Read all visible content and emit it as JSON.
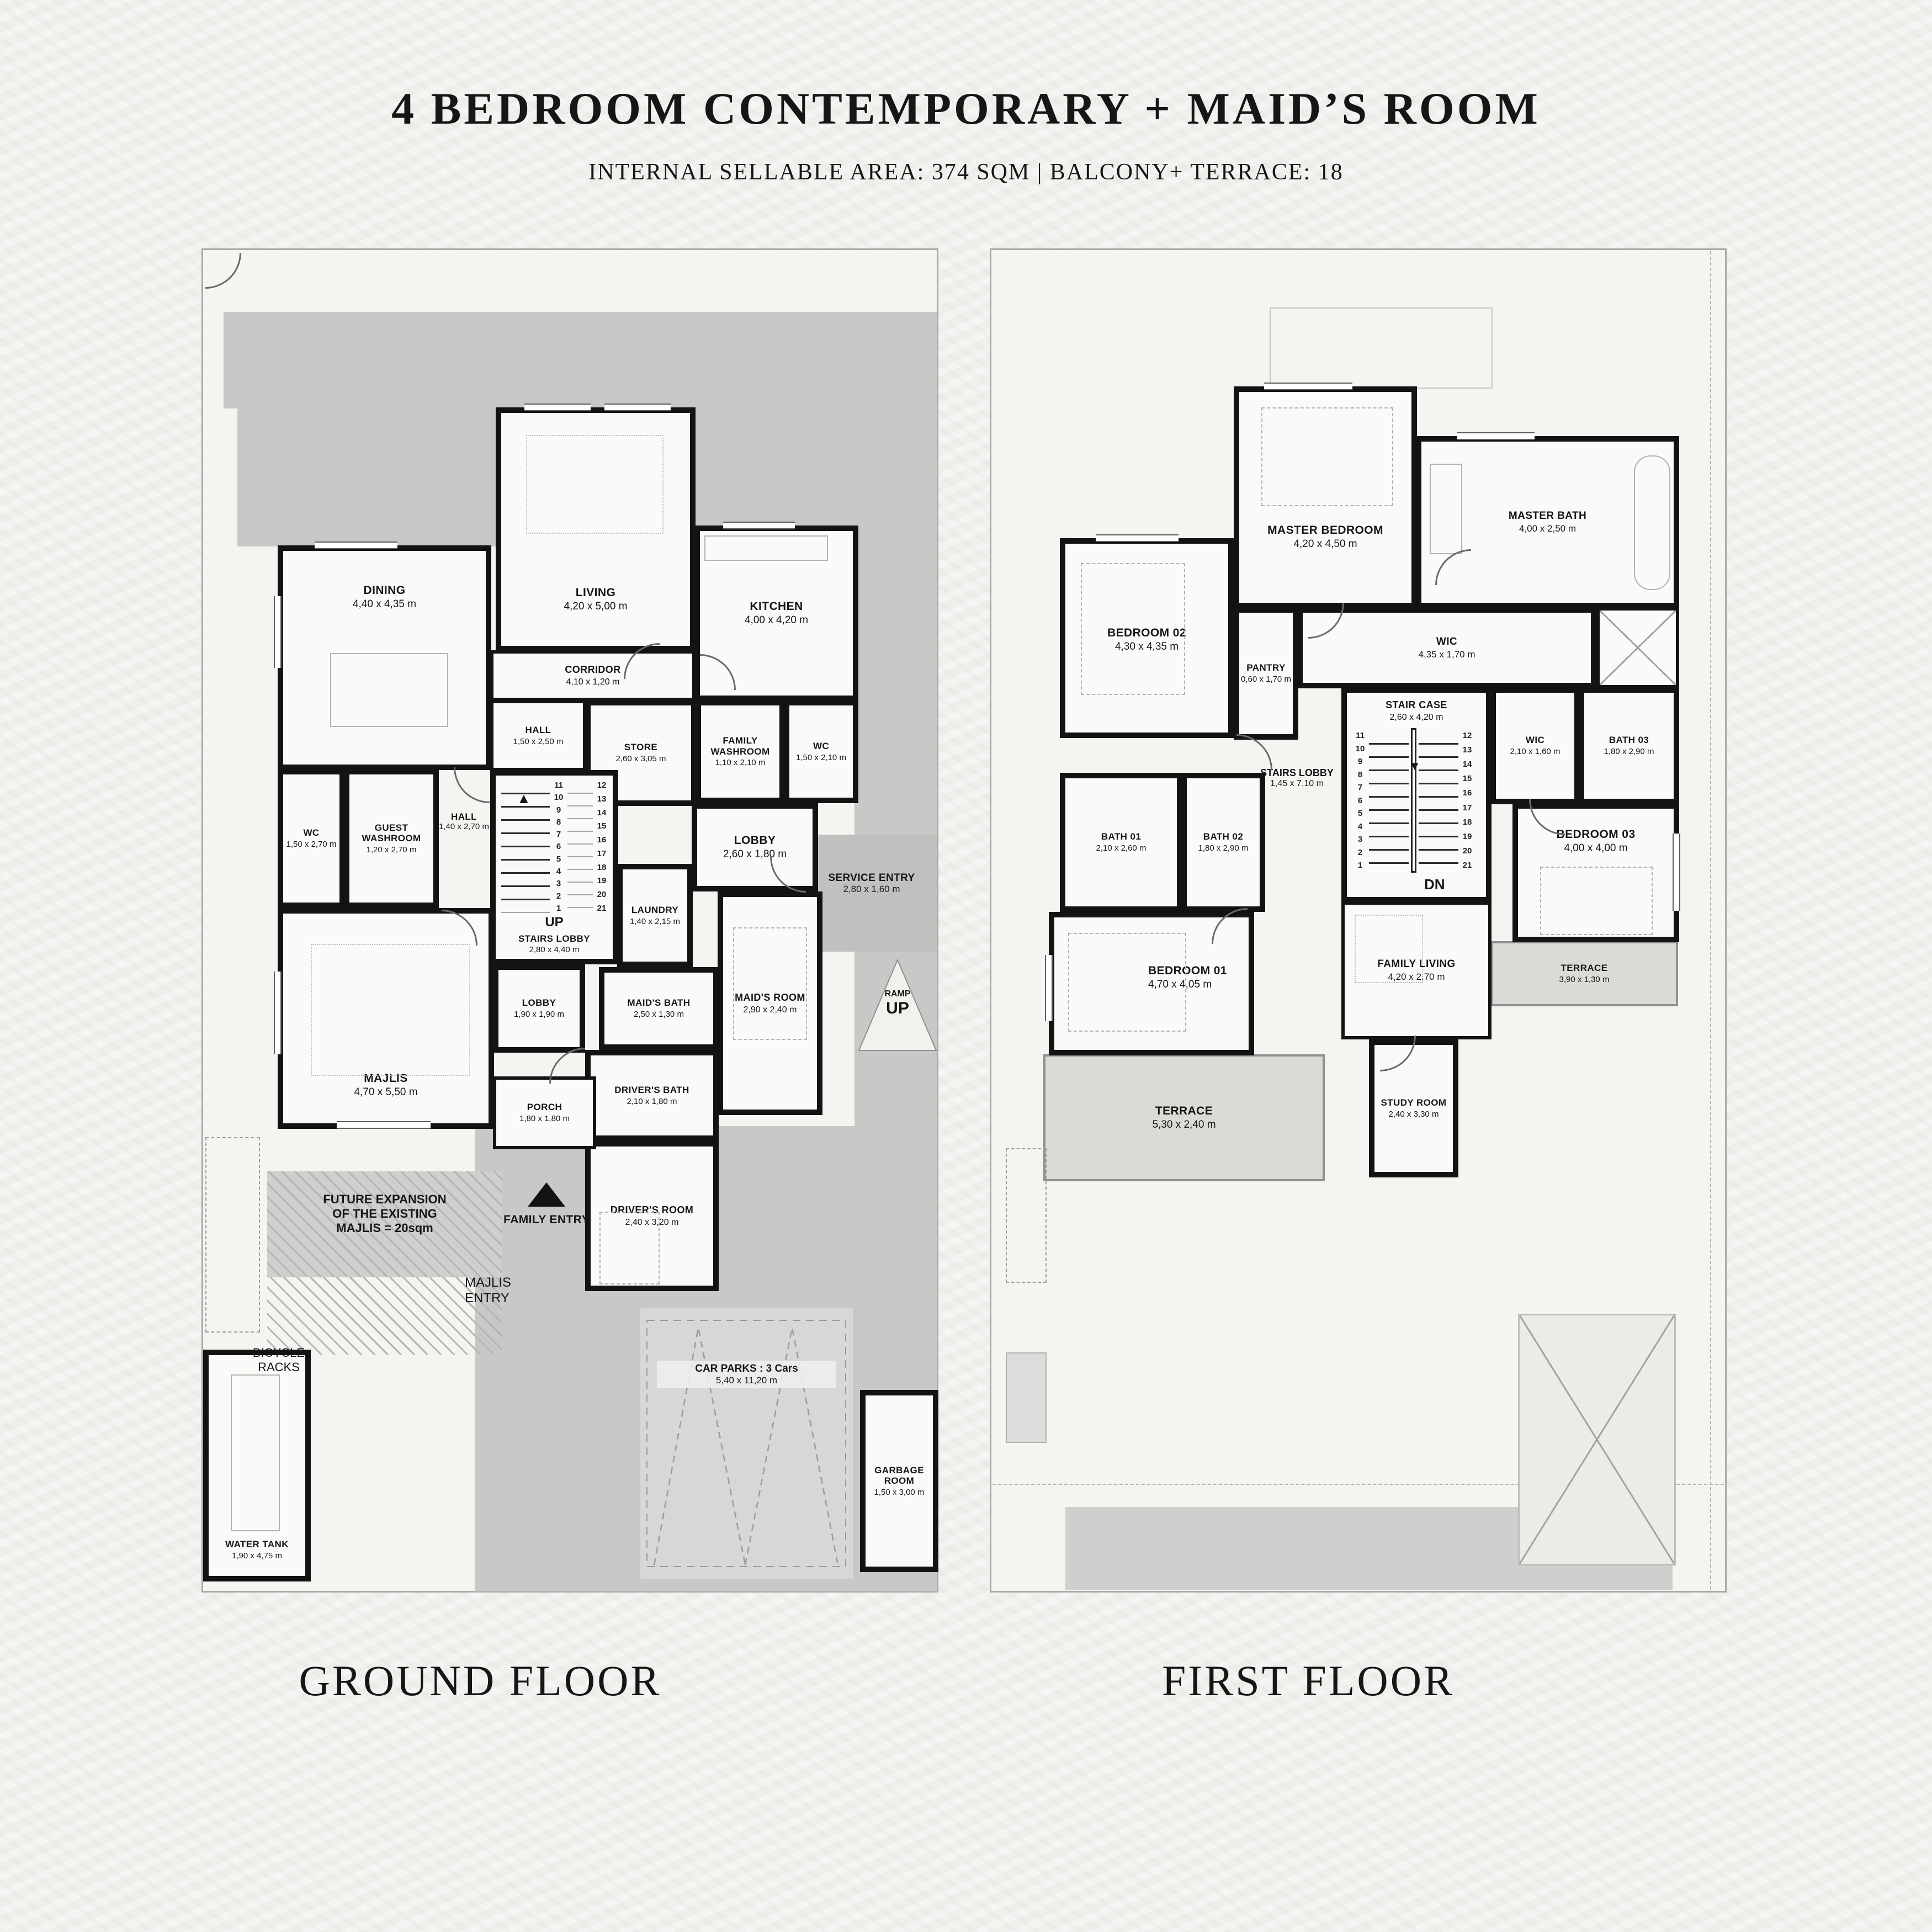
{
  "header": {
    "title": "4 BEDROOM CONTEMPORARY + MAID’S ROOM",
    "subtitle": "INTERNAL SELLABLE AREA: 374 SQM | BALCONY+ TERRACE: 18"
  },
  "floors": {
    "ground": {
      "caption": "GROUND FLOOR",
      "stairs": {
        "dir": "UP",
        "col1": [
          "11",
          "10",
          "9",
          "8",
          "7",
          "6",
          "5",
          "4",
          "3",
          "2",
          "1"
        ],
        "col2": [
          "12",
          "13",
          "14",
          "15",
          "16",
          "17",
          "18",
          "19",
          "20",
          "21"
        ]
      },
      "rooms": {
        "dining": {
          "name": "DINING",
          "dims": "4,40 x 4,35 m"
        },
        "living": {
          "name": "LIVING",
          "dims": "4,20 x 5,00 m"
        },
        "kitchen": {
          "name": "KITCHEN",
          "dims": "4,00 x 4,20 m"
        },
        "corridor": {
          "name": "CORRIDOR",
          "dims": "4,10 x 1,20 m"
        },
        "hall_upper": {
          "name": "HALL",
          "dims": "1,50 x 2,50 m"
        },
        "store": {
          "name": "STORE",
          "dims": "2,60 x 3,05 m"
        },
        "family_washroom": {
          "name": "FAMILY WASHROOM",
          "dims": "1,10 x 2,10 m"
        },
        "wc_service": {
          "name": "WC",
          "dims": "1,50 x 2,10 m"
        },
        "wc_guest": {
          "name": "WC",
          "dims": "1,50 x 2,70 m"
        },
        "guest_washroom": {
          "name": "GUEST WASHROOM",
          "dims": "1,20 x 2,70 m"
        },
        "hall_lower": {
          "name": "HALL",
          "dims": "1,40 x 2,70 m"
        },
        "stairs_lobby": {
          "name": "STAIRS LOBBY",
          "dims": "2,80 x 4,40 m"
        },
        "laundry": {
          "name": "LAUNDRY",
          "dims": "1,40 x 2,15 m"
        },
        "lobby": {
          "name": "LOBBY",
          "dims": "2,60 x 1,80 m"
        },
        "service_entry": {
          "name": "SERVICE ENTRY",
          "dims": "2,80 x 1,60 m"
        },
        "maids_room": {
          "name": "MAID'S ROOM",
          "dims": "2,90 x 2,40 m"
        },
        "maids_bath": {
          "name": "MAID'S BATH",
          "dims": "2,50 x 1,30 m"
        },
        "majlis": {
          "name": "MAJLIS",
          "dims": "4,70 x 5,50 m"
        },
        "lobby_majlis": {
          "name": "LOBBY",
          "dims": "1,90 x 1,90 m"
        },
        "drivers_bath": {
          "name": "DRIVER'S BATH",
          "dims": "2,10 x 1,80 m"
        },
        "drivers_room": {
          "name": "DRIVER'S ROOM",
          "dims": "2,40 x 3,20 m"
        },
        "porch": {
          "name": "PORCH",
          "dims": "1,80 x 1,80 m"
        },
        "water_tank": {
          "name": "WATER TANK",
          "dims": "1,90 x 4,75 m"
        },
        "car_parks": {
          "name": "CAR PARKS : 3 Cars",
          "dims": "5,40 x 11,20 m"
        },
        "garbage_room": {
          "name": "GARBAGE ROOM",
          "dims": "1,50 x 3,00 m"
        }
      },
      "site": {
        "ramp_line1": "RAMP",
        "ramp_line2": "UP",
        "family_entry": "FAMILY ENTRY",
        "majlis_entry_line1": "MAJLIS",
        "majlis_entry_line2": "ENTRY",
        "future_line1": "FUTURE EXPANSION",
        "future_line2": "OF THE EXISTING",
        "future_line3": "MAJLIS = 20sqm",
        "bicycle_line1": "BICYCLE",
        "bicycle_line2": "RACKS"
      }
    },
    "first": {
      "caption": "FIRST FLOOR",
      "stairs": {
        "dir": "DN",
        "col1": [
          "11",
          "10",
          "9",
          "8",
          "7",
          "6",
          "5",
          "4",
          "3",
          "2",
          "1"
        ],
        "col2": [
          "12",
          "13",
          "14",
          "15",
          "16",
          "17",
          "18",
          "19",
          "20",
          "21"
        ]
      },
      "rooms": {
        "master_bedroom": {
          "name": "MASTER BEDROOM",
          "dims": "4,20 x 4,50 m"
        },
        "master_bath": {
          "name": "MASTER BATH",
          "dims": "4,00 x 2,50 m"
        },
        "wic_master": {
          "name": "WIC",
          "dims": "4,35 x 1,70 m"
        },
        "pantry": {
          "name": "PANTRY",
          "dims": "0,60 x 1,70 m"
        },
        "bedroom_02": {
          "name": "BEDROOM 02",
          "dims": "4,30 x 4,35 m"
        },
        "stair_case": {
          "name": "STAIR CASE",
          "dims": "2,60 x 4,20 m"
        },
        "stairs_lobby": {
          "name": "STAIRS LOBBY",
          "dims": "1,45 x 7,10 m"
        },
        "bath_01": {
          "name": "BATH 01",
          "dims": "2,10 x 2,60 m"
        },
        "bath_02": {
          "name": "BATH 02",
          "dims": "1,80 x 2,90 m"
        },
        "bath_03": {
          "name": "BATH 03",
          "dims": "1,80 x 2,90 m"
        },
        "wic_03": {
          "name": "WIC",
          "dims": "2,10 x 1,60 m"
        },
        "bedroom_03": {
          "name": "BEDROOM 03",
          "dims": "4,00 x 4,00 m"
        },
        "bedroom_01": {
          "name": "BEDROOM 01",
          "dims": "4,70 x 4,05 m"
        },
        "family_living": {
          "name": "FAMILY LIVING",
          "dims": "4,20 x 2,70 m"
        },
        "terrace_left": {
          "name": "TERRACE",
          "dims": "5,30 x 2,40 m"
        },
        "terrace_right": {
          "name": "TERRACE",
          "dims": "3,90 x 1,30 m"
        },
        "study_room": {
          "name": "STUDY ROOM",
          "dims": "2,40 x 3,30 m"
        }
      }
    }
  }
}
